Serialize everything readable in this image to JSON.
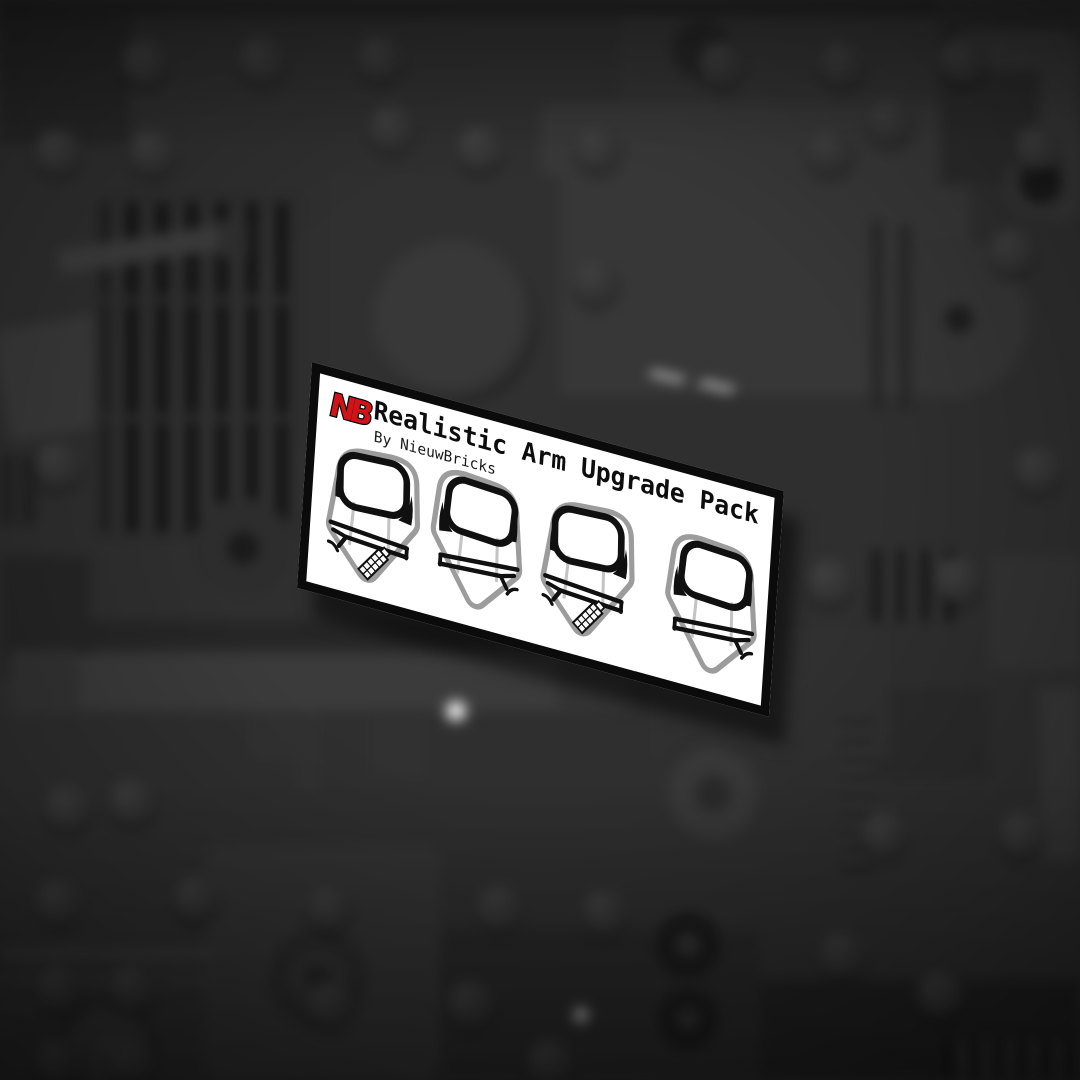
{
  "card": {
    "logo_text": "NB",
    "title": "Realistic Arm Upgrade Pack",
    "subtitle": "By NieuwBricks",
    "arms": [
      {
        "label": "minifig-arm-left-printed-graphic",
        "side": "left",
        "printed": true
      },
      {
        "label": "minifig-arm-right-plain-graphic",
        "side": "right",
        "printed": false
      },
      {
        "label": "minifig-arm-left-printed-graphic",
        "side": "left",
        "printed": true
      },
      {
        "label": "minifig-arm-right-plain-graphic",
        "side": "right",
        "printed": false
      }
    ]
  },
  "colors": {
    "brand_red": "#d01318",
    "card_bg": "#ffffff",
    "card_border": "#0b0b0b",
    "arm_outline": "#9c9c9c",
    "background_base": "#2f2f2f"
  }
}
